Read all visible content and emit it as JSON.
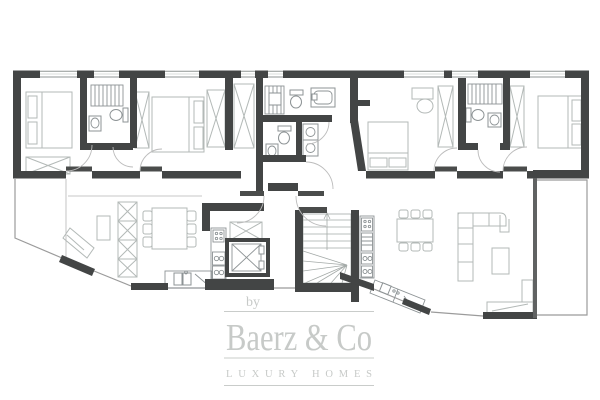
{
  "watermark": {
    "prefix": "by",
    "brand": "Baerz & Co",
    "tagline": "LUXURY HOMES"
  },
  "colors": {
    "wall": "#434545",
    "window_line": "#8f9594",
    "furniture_line": "#b3b9b7",
    "fixture_line": "#8d9395",
    "terrace_line": "#9b9b9b",
    "door_arc": "#bcbcbc",
    "watermark": "#c7cac8",
    "background": "#ffffff"
  }
}
